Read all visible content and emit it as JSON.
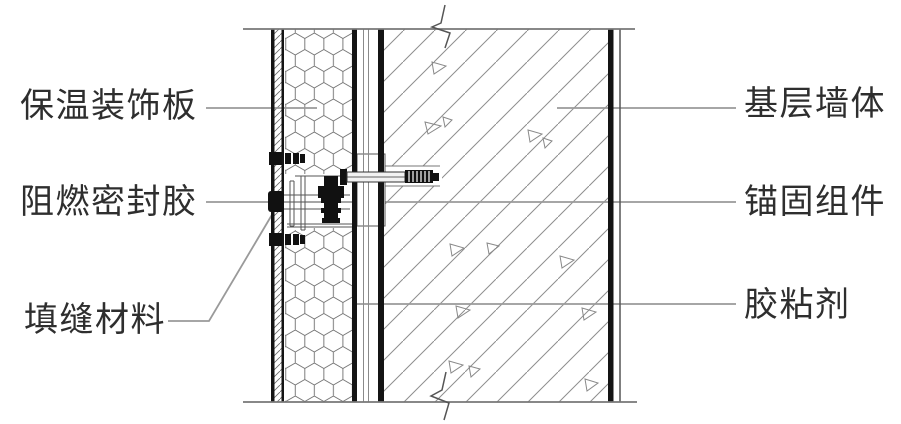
{
  "diagram": {
    "type": "wall-section-construction-detail",
    "labels": {
      "left": [
        {
          "text": "保温装饰板"
        },
        {
          "text": "阻燃密封胶"
        },
        {
          "text": "填缝材料"
        }
      ],
      "right": [
        {
          "text": "基层墙体"
        },
        {
          "text": "锚固组件"
        },
        {
          "text": "胶粘剂"
        }
      ]
    },
    "colors": {
      "line_dark": "#141414",
      "line_medium": "#666666",
      "leader": "#9a9a9a",
      "text": "#2e2e2e",
      "background": "#ffffff"
    }
  }
}
